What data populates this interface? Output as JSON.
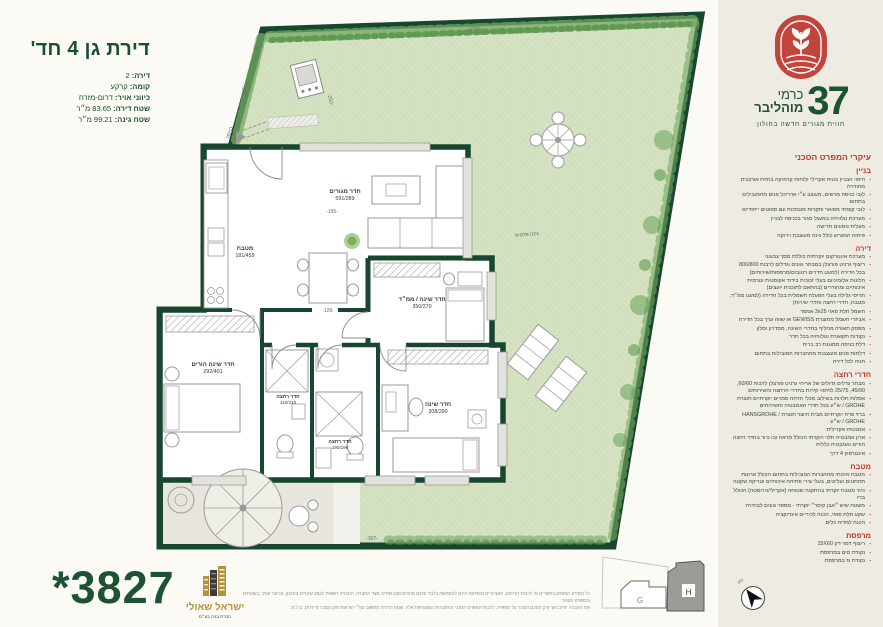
{
  "colors": {
    "wall_green": "#17472e",
    "garden": "#d4e2c2",
    "accent_red": "#bf3a30",
    "brand_green": "#1d5233",
    "gold": "#b4923d",
    "sidebar_bg": "#edebe2"
  },
  "title_block": {
    "title": "דירת גן 4 חד'",
    "details": [
      {
        "label": "דירה:",
        "value": "2"
      },
      {
        "label": "קומה:",
        "value": "קרקע"
      },
      {
        "label": "כיווני אויר:",
        "value": "דרום-מזרח"
      },
      {
        "label": "שטח דירה:",
        "value": "83.65 מ״ר"
      },
      {
        "label": "שטח גינה:",
        "value": "99.21 מ״ר"
      }
    ]
  },
  "brand": {
    "project_word1": "כרמי",
    "project_word2": "מוהליבר",
    "project_number": "37",
    "tagline": "חווית מגורים חדשה בחולון"
  },
  "specs": {
    "heading": "עיקרי המפרט הטכני",
    "sections": [
      {
        "title": "בניין",
        "items": [
          "חיפוי הבניין בטיח אקרילי ולוחות קרמיקה בחזית אורבנית מהודרת",
          "לובי כניסה מרשים, מעוצב ע״י אדריכל פנים מהמובילים בתחום",
          "לובי קומתי מפואר ותקרות מונמכות עם ספוטים ייחודיים",
          "מערכת טלוויזיה במעגל סגור בכניסה לבניין",
          "מעלית נוסעים חדישה",
          "פיתוח המגרש כולל גינה מעוצבת וירוקה"
        ]
      },
      {
        "title": "דירה",
        "items": [
          "מערכת אינטרקום יוקרתית כוללת מסך צבעוני",
          "ריצוף גרניט פורצלן במבחר גוונים וגדלים לרבות 800/800 בכל הדירה (למעט חדרים רטובים/מרפסות/שירותים)",
          "חלונות אלומיניום בעלי זכוכית בידוד אקוסטית וטרמית איכותיים ומהודרים (בהתאם לתוכנית יועצים)",
          "תריסי גלילה בעלי הפעלה חשמלית בכל הדירה (למעט ממ״ד, מטבח, חדרי רחצה וחדרי שירות)",
          "חשמל תלת פאזי 3x25 אמפר",
          "אביזרי חשמל מתוצרת GEWISS או שווה ערך בכל הדירה",
          "מפסק תאורה מחליף בחדרי השינה, מסדרון וסלון",
          "נקודות תקשורת וטלוויזיה בכל חדר",
          "דלת כניסה ממוגנת רב בריח",
          "דלתות פנים מעוצבות מהחברות המובילות בתחום",
          "חניה לכל דירה"
        ]
      },
      {
        "title": "חדרי רחצה",
        "items": [
          "מבחר גדלים גדולים של אריחי גרניט פורצלן לרבות 60/60, 45/90, 25/75 לחיפוי קירות בחדרי הרחצה והשירותים",
          "אסלות תלויות בשילוב מכלי הדחה סמויים יוקרתיים תוצרת GROHE / ש״ע בכל חדרי האמבטיה והשירותים",
          "ברזי פרח יוקרתיים מבית היוצר תוצרת HANSGROHE / GROHE / ש״ע",
          "אמבטיה אקרילית",
          "ארון אמבטיה תלוי ויוקרתי הכולל מראה ובו כיור בחדר רחצה הורים ואמבטיה כללית",
          "אינטרפוץ 4 דרך"
        ]
      },
      {
        "title": "מטבח",
        "items": [
          "מטבח איכותי מהחברות המובילות בתחום הכולל ארונות תחתונים ועליונים, בעלי צירי פתיחה איכותיים וטריקה שקטה",
          "כיור מטבח יוקרתי בהתקנה שטוחה (אקרילי/נירוסטה) הכולל ברז",
          "משטח שיש ״אבן קיסר״ יוקרתי - מספר גוונים לבחירה",
          "שקע תלת פאזי, הכנה לכיריים אינדוקציה",
          "הכנה למדיח כלים"
        ]
      },
      {
        "title": "מרפסת",
        "items": [
          "ריצוף דמוי דק 15X60",
          "נקודת מים במרפסת",
          "נקודת גז במרפסת"
        ]
      }
    ]
  },
  "plan": {
    "rooms": [
      {
        "name": "חדר מגורים",
        "dims": "591/289"
      },
      {
        "name": "מטבח",
        "dims": "181/459"
      },
      {
        "name": "חדר שינה / ממ״ד",
        "dims": "350/270"
      },
      {
        "name": "חדר שינה הורים",
        "dims": "292/401"
      },
      {
        "name": "חדר שינה",
        "dims": "308/290"
      },
      {
        "name": "חדר רחצה",
        "dims": "110/210"
      },
      {
        "name": "חדר רחצה",
        "dims": "190/190"
      }
    ],
    "garden_label": "גינה פרטית",
    "entrance_label": "כניסה",
    "dims": {
      "d195": "-195-",
      "d128": "-128-",
      "d250": "-250-",
      "d517": "-517-",
      "d1101": "-1101-",
      "d307": "-307-"
    }
  },
  "siteplan": {
    "building_g": "G",
    "building_h": "H",
    "north": "צפון"
  },
  "footer": {
    "phone": "*3827",
    "developer": "ישראל שאולי",
    "developer_tagline": "חברת בניה בע״מ",
    "disclaimer_line1": "כל המידע המופיע בתשריט זה לרבות הריהוט, האביזרים והפיתוח הינם להמחשה בלבד ואינם מהווים מצג מחייב מצד החברה. החברה רשאית לבצע שינויים בתכנון, בכיווני אוויר, בשטחים ובמפרט הטכני.",
    "disclaimer_line2": "את החברה יחייבו אך ורק הסכם המכר על נספחיו, לרבות המפרט הטכני והתוכניות המצורפות אליו. שטח הדירה מחושב עפ״י הוראות חוק המכר (דירות). ט.ל.ח."
  }
}
